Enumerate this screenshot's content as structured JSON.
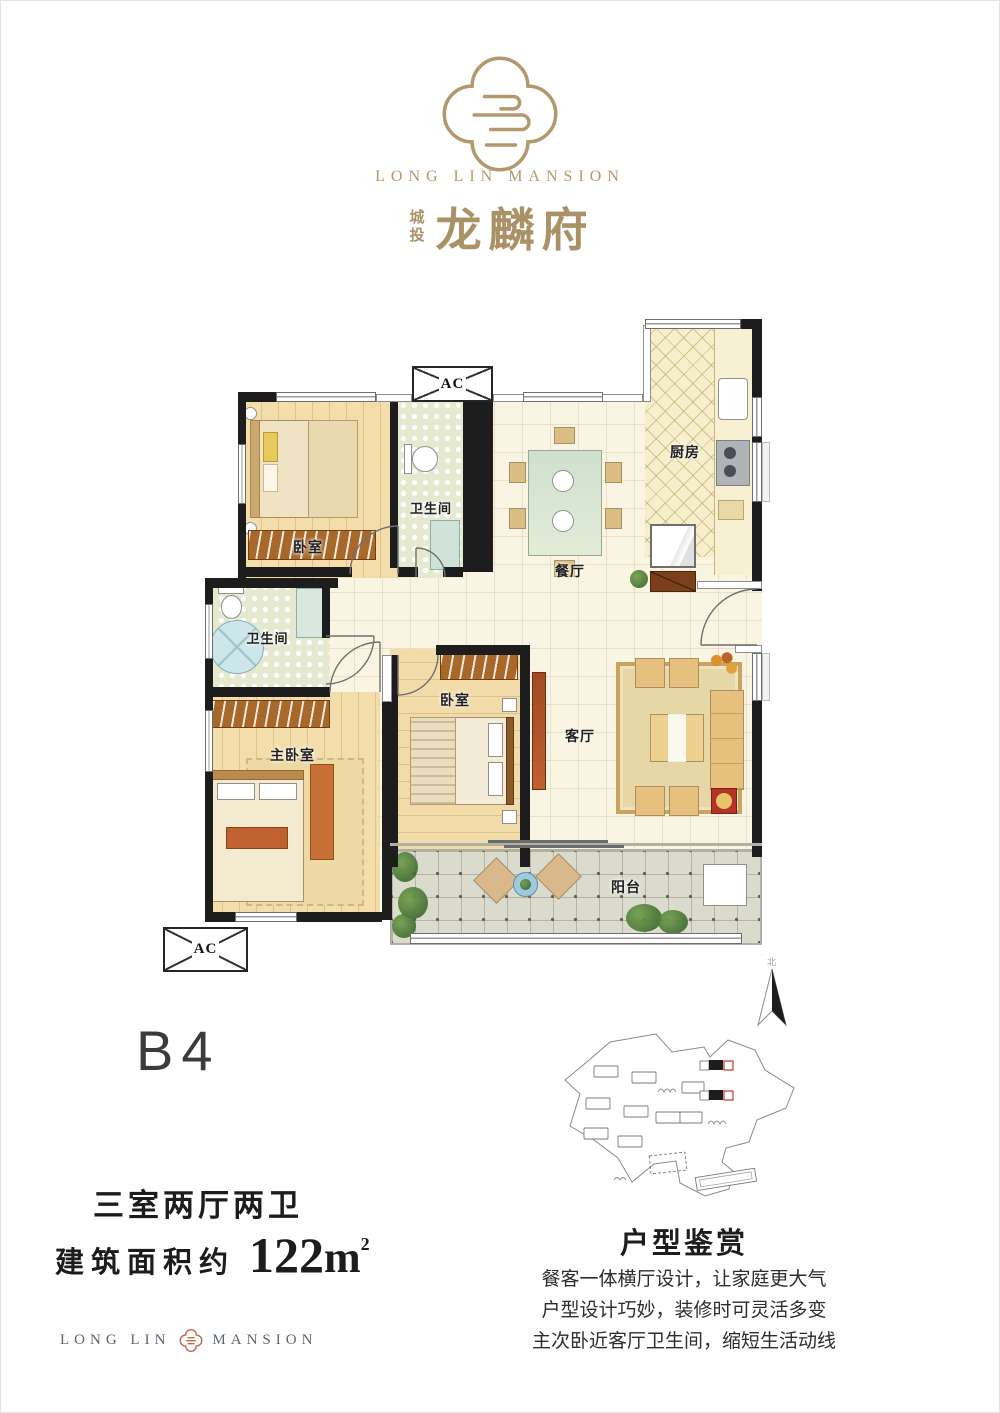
{
  "header": {
    "brand_en": "LONG LIN MANSION",
    "brand_prefix_cn": "城投",
    "brand_cn": "龙麟府",
    "gold": "#b3986e"
  },
  "floorplan": {
    "ac_label": "AC",
    "north_label": "北",
    "rooms": [
      {
        "id": "bedroom-top",
        "label": "卧室"
      },
      {
        "id": "bathroom-top",
        "label": "卫生间"
      },
      {
        "id": "dining",
        "label": "餐厅"
      },
      {
        "id": "kitchen",
        "label": "厨房"
      },
      {
        "id": "bathroom-left",
        "label": "卫生间"
      },
      {
        "id": "master-bedroom",
        "label": "主卧室"
      },
      {
        "id": "bedroom-middle",
        "label": "卧室"
      },
      {
        "id": "living",
        "label": "客厅"
      },
      {
        "id": "balcony",
        "label": "阳台"
      }
    ]
  },
  "unit": {
    "code": "B4",
    "layout_text": "三室两厅两卫",
    "area_prefix": "建筑面积约",
    "area_number": "122",
    "area_unit": "m",
    "area_sup": "2"
  },
  "review": {
    "title": "户型鉴赏",
    "lines": [
      "餐客一体横厅设计，让家庭更大气",
      "户型设计巧妙，装修时可灵活多变",
      "主次卧近客厅卫生间，缩短生活动线"
    ]
  },
  "footer": {
    "brand_left": "LONG LIN",
    "brand_right": "MANSION"
  }
}
